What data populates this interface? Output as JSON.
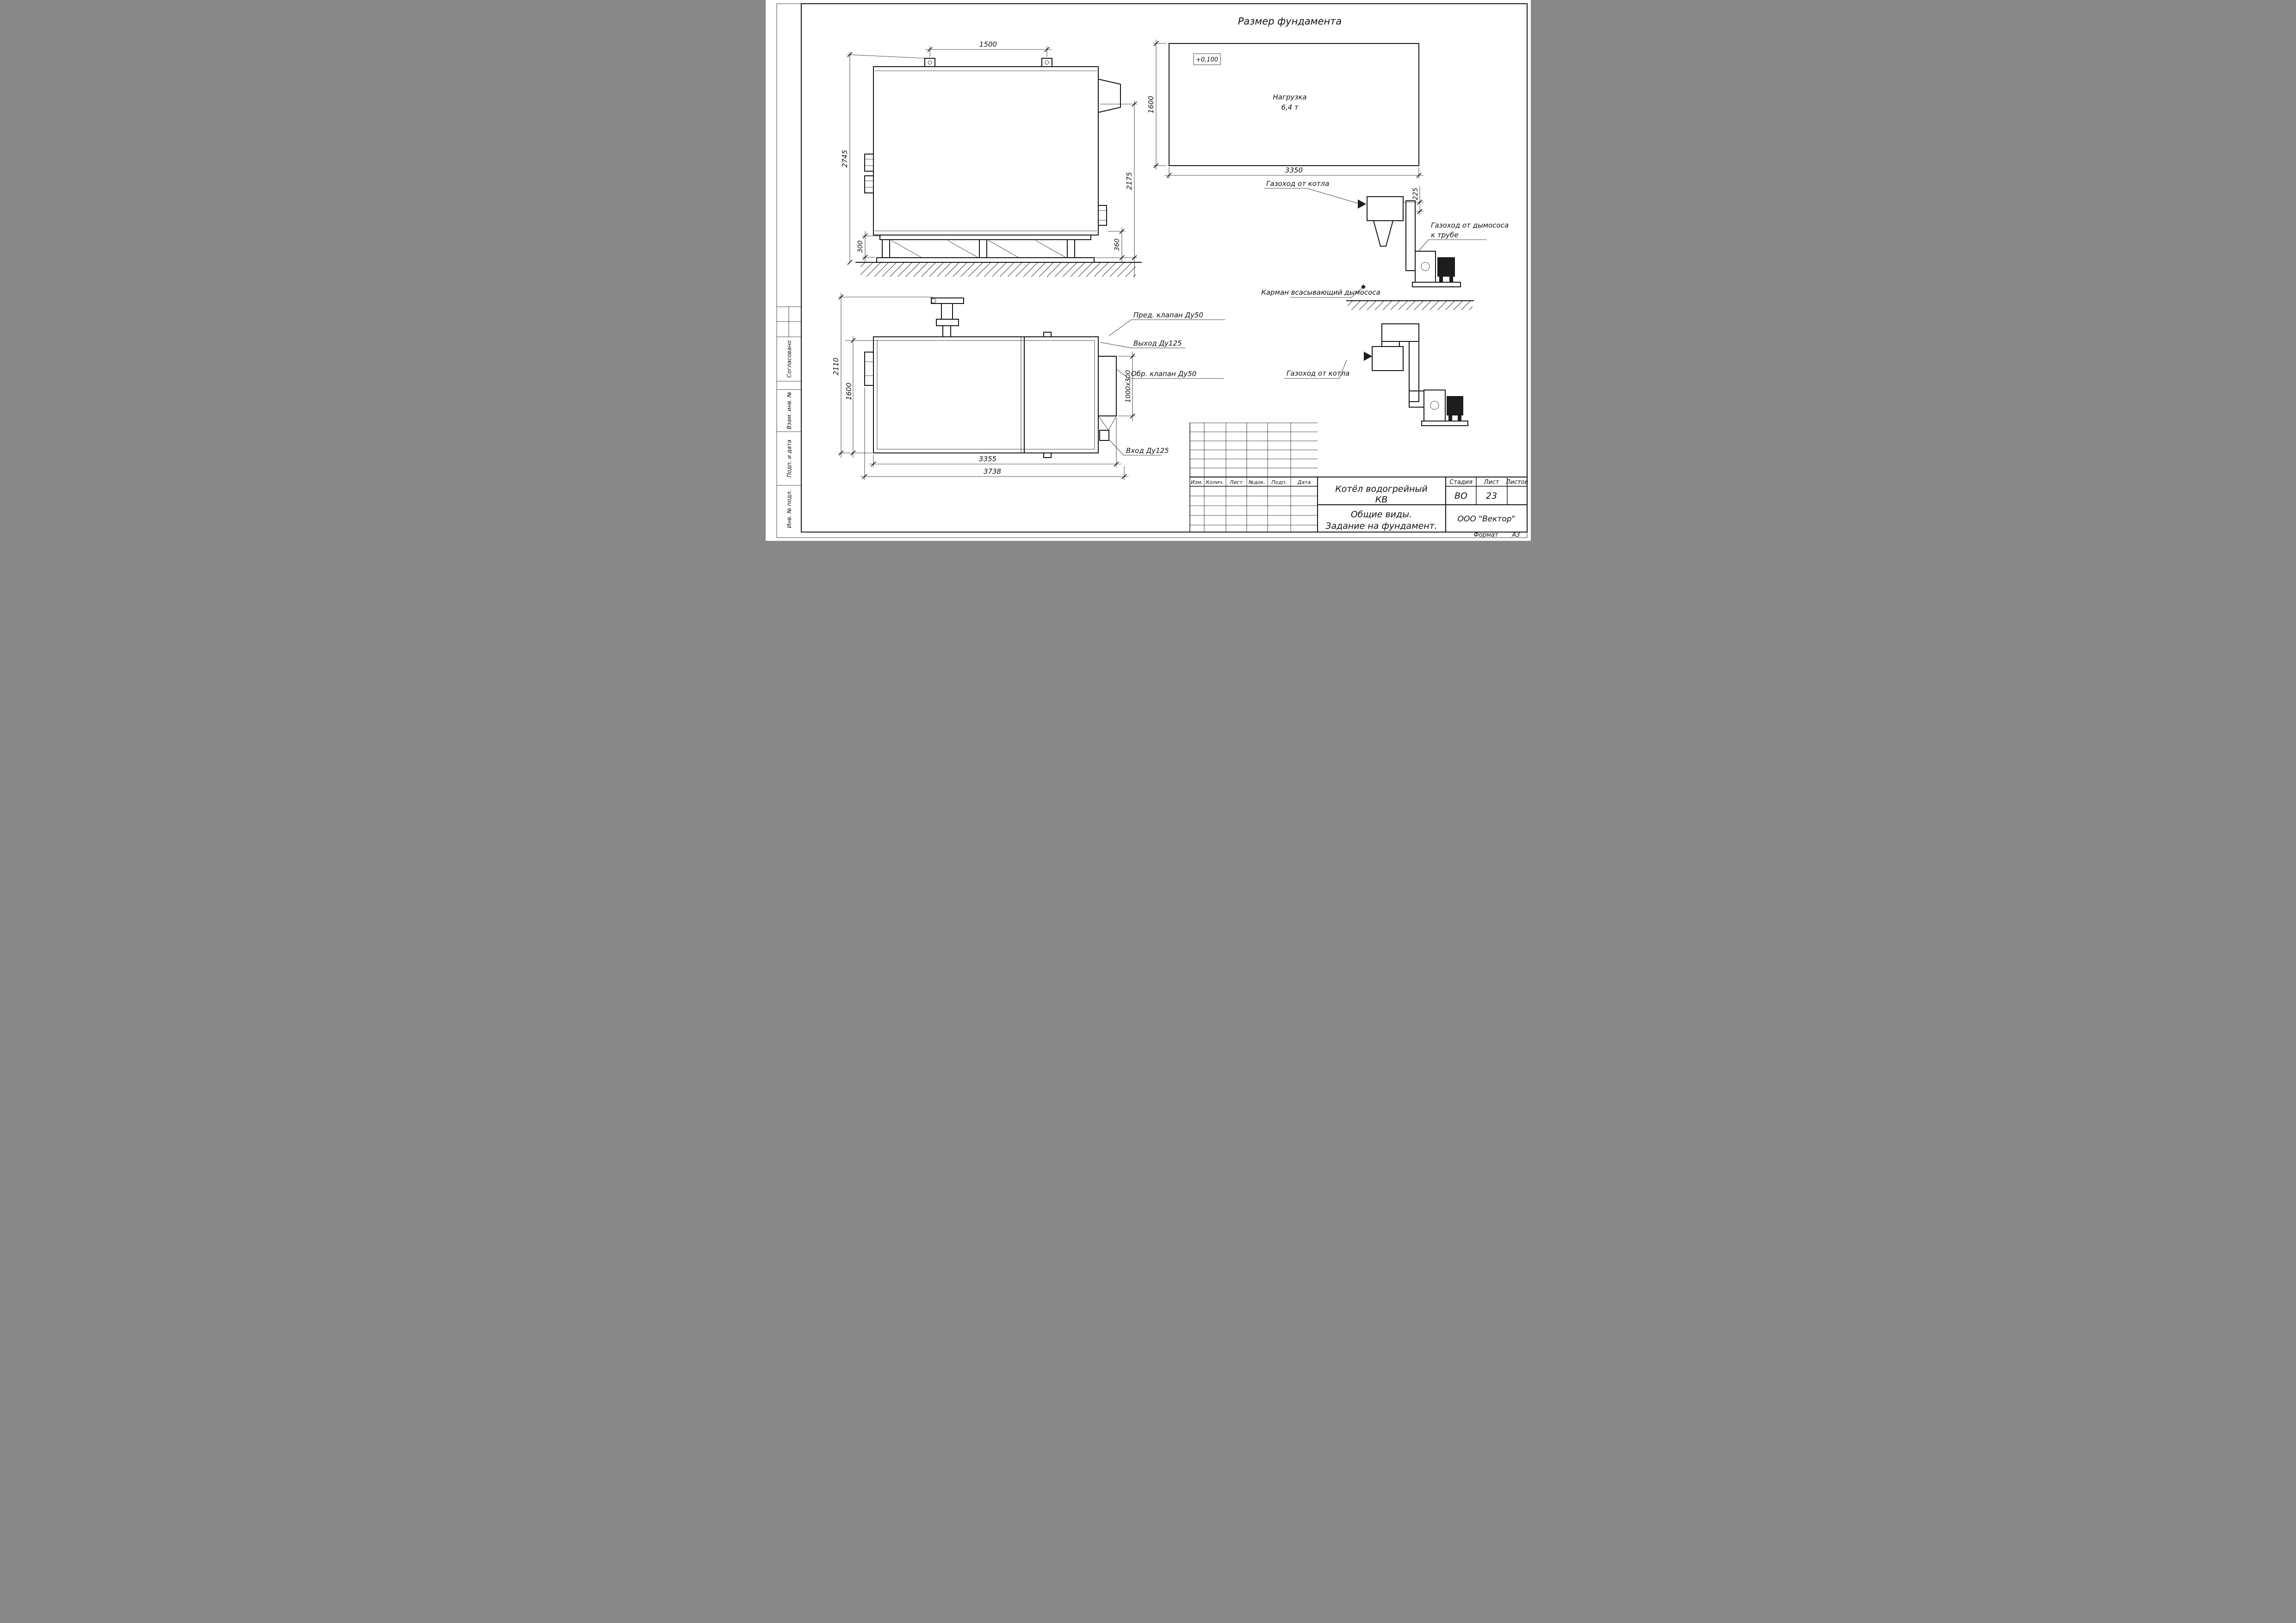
{
  "page": {
    "title": "Размер фундамента",
    "format_label": "Формат",
    "format_value": "А3"
  },
  "side_view": {
    "dims": {
      "top": "1500",
      "height": "2745",
      "right_height": "2175",
      "foot_left": "300",
      "foot_right": "360"
    }
  },
  "plan_view": {
    "dims": {
      "height": "2110",
      "inner_height": "1600",
      "length": "3355",
      "total_length": "3738",
      "flue_opening": "1000x300"
    },
    "labels": {
      "safety_valve": "Пред. клапан Ду50",
      "outlet": "Выход Ду125",
      "check_valve": "Обр. клапан Ду50",
      "inlet": "Вход Ду125"
    }
  },
  "foundation": {
    "level_mark": "+0,100",
    "load_line1": "Нагрузка",
    "load_line2": "6,4 т",
    "dims": {
      "width": "1600",
      "length": "3350",
      "offset": "225"
    }
  },
  "flue_views": {
    "from_boiler_top": "Газоход от котла",
    "to_stack_line1": "Газоход от дымососа",
    "to_stack_line2": "к трубе",
    "suction_pocket": "Карман всасывающий дымососа",
    "from_boiler_bottom": "Газоход от котла"
  },
  "stamp_column": {
    "agreed": "Согласовано",
    "replace_inv": "Взам. инв. №",
    "sign_date": "Подп. и дата",
    "inv_orig": "Инв. № подл."
  },
  "revision_table": {
    "headers": [
      "Изм.",
      "Колич.",
      "Лист",
      "№док.",
      "Подп.",
      "Дата"
    ]
  },
  "title_block": {
    "doc_name_line1": "Котёл водогрейный",
    "doc_name_line2": "КВ",
    "stage_label": "Стадия",
    "stage_value": "ВО",
    "sheet_label": "Лист",
    "sheet_value": "23",
    "sheets_label": "Листов",
    "sheets_value": "",
    "subtitle_line1": "Общие виды.",
    "subtitle_line2": "Задание на фундамент.",
    "company": "ООО \"Вектор\""
  }
}
